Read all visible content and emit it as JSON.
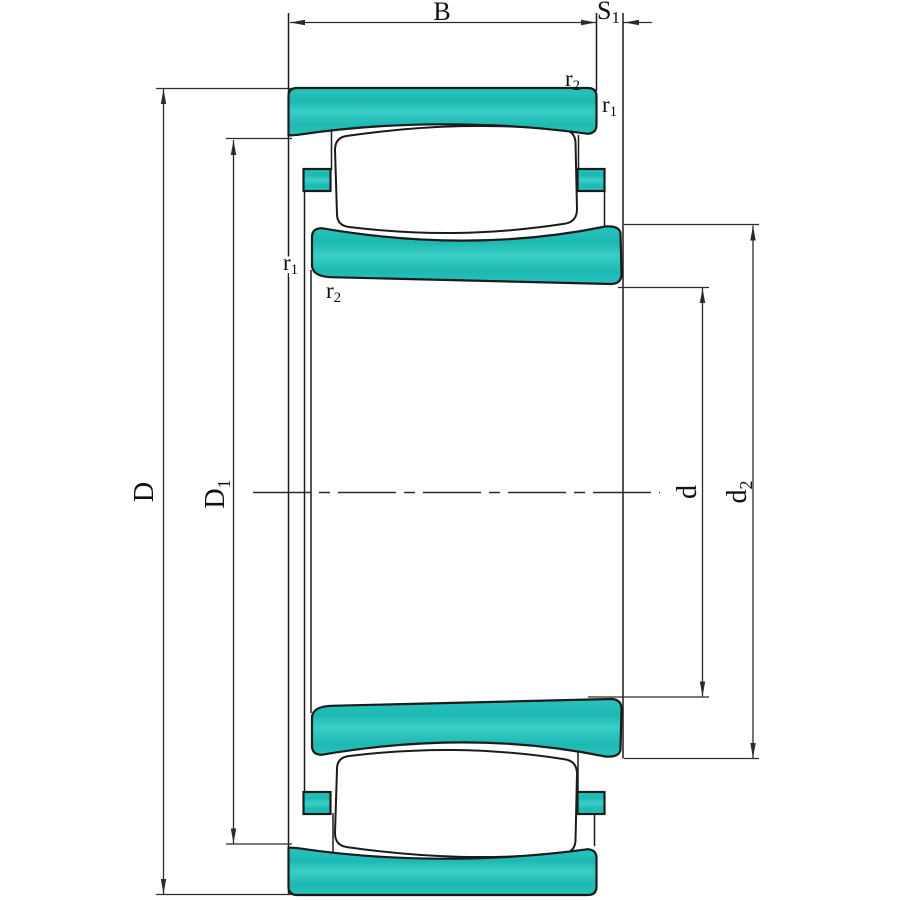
{
  "drawing": {
    "type": "bearing-cross-section",
    "description": "Dimensioned section drawing of a toroidal roller bearing"
  },
  "colors": {
    "background": "#ffffff",
    "ring_fill": "#27c4be",
    "ring_fill_dark": "#1eb8b2",
    "ring_fill_light": "#3bcec8",
    "outline": "#1b1b1b",
    "dimension_line": "#2b2b2b",
    "text": "#111111"
  },
  "labels": {
    "B": {
      "base": "B"
    },
    "S1": {
      "base": "S",
      "sub": "1"
    },
    "D": {
      "base": "D"
    },
    "D1": {
      "base": "D",
      "sub": "1"
    },
    "d": {
      "base": "d"
    },
    "d2": {
      "base": "d",
      "sub": "2"
    },
    "r1": {
      "base": "r",
      "sub": "1"
    },
    "r2": {
      "base": "r",
      "sub": "2"
    }
  }
}
